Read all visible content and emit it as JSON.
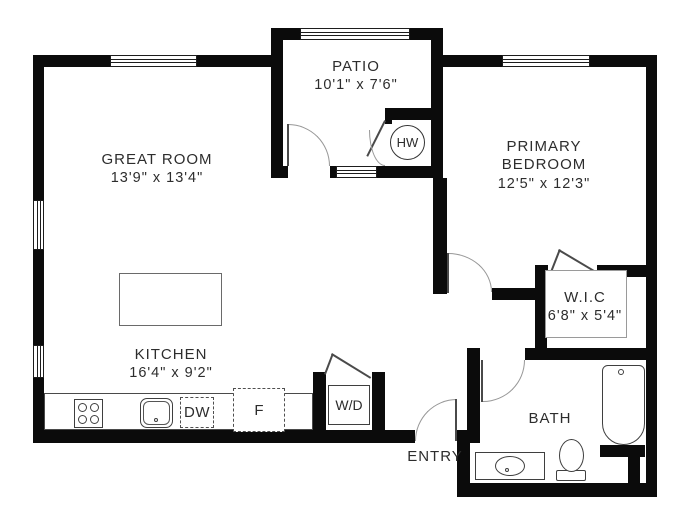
{
  "rooms": {
    "great_room": {
      "name": "GREAT ROOM",
      "dims": "13'9\" x 13'4\""
    },
    "patio": {
      "name": "PATIO",
      "dims": "10'1\" x 7'6\""
    },
    "primary_bedroom": {
      "name": "PRIMARY BEDROOM",
      "dims": "12'5\" x 12'3\""
    },
    "wic": {
      "name": "W.I.C",
      "dims": "6'8\" x 5'4\""
    },
    "kitchen": {
      "name": "KITCHEN",
      "dims": "16'4\" x 9'2\""
    },
    "bath": {
      "name": "BATH"
    },
    "entry": {
      "name": "ENTRY"
    }
  },
  "fixtures": {
    "hot_water_heater": "HW",
    "washer_dryer": "W/D",
    "dishwasher": "DW",
    "refrigerator": "F"
  },
  "colors": {
    "wall": "#0b0b0b",
    "line": "#3f3f3f",
    "text": "#2d2d2d",
    "background": "#ffffff"
  }
}
